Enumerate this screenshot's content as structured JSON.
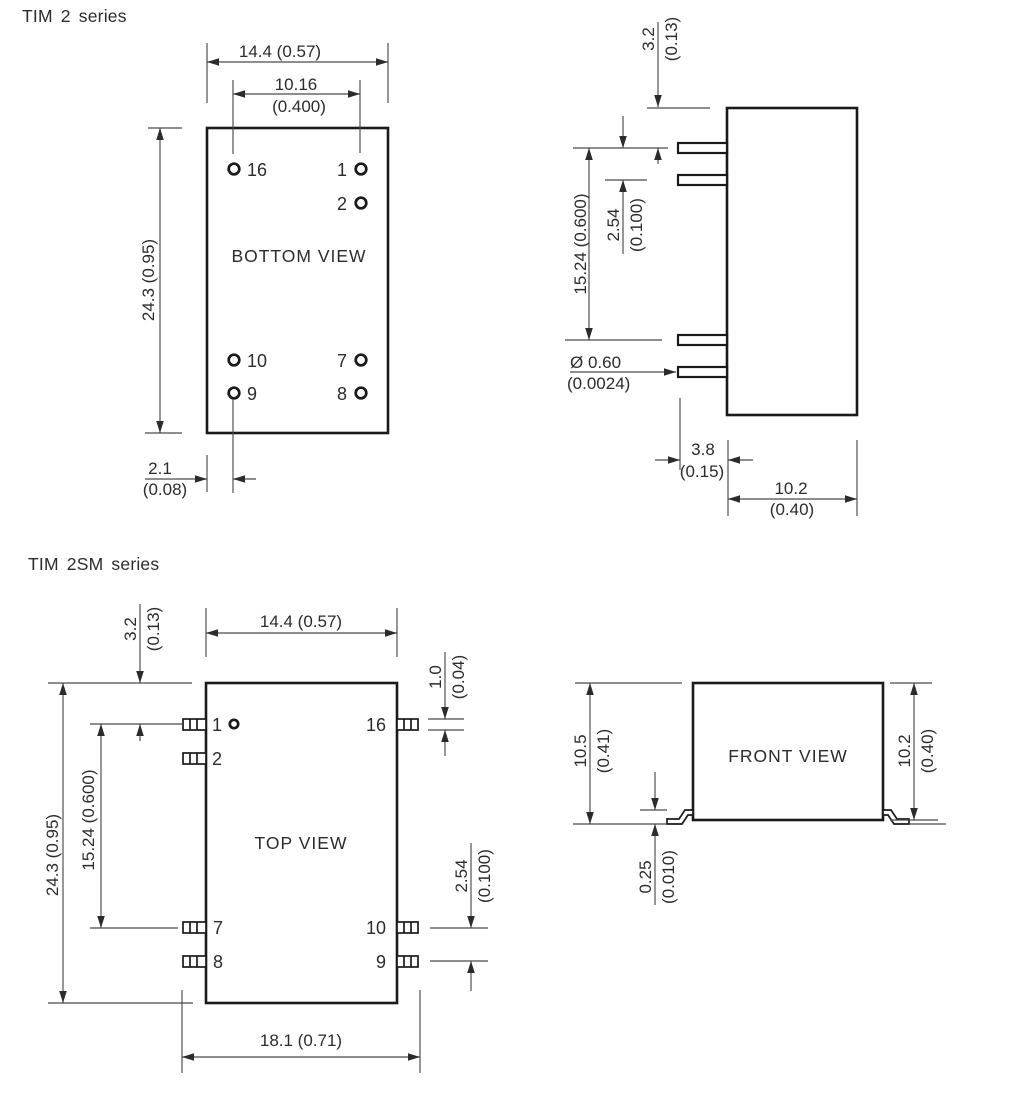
{
  "figures": {
    "tim2": {
      "title": "TIM 2 series",
      "bottom_view": {
        "view_label": "BOTTOM VIEW",
        "pins": {
          "p16": "16",
          "p1": "1",
          "p2": "2",
          "p10": "10",
          "p9": "9",
          "p7": "7",
          "p8": "8"
        },
        "dims": {
          "width": "14.4 (0.57)",
          "pin_span_mm": "10.16",
          "pin_span_in": "(0.400)",
          "height": "24.3 (0.95)",
          "offset_mm": "2.1",
          "offset_in": "(0.08)"
        }
      },
      "side_view": {
        "dims": {
          "standoff_mm": "3.2",
          "standoff_in": "(0.13)",
          "pitch_mm": "2.54",
          "pitch_in": "(0.100)",
          "row_span": "15.24 (0.600)",
          "pin_dia_mm": "Ø 0.60",
          "pin_dia_in": "(0.0024)",
          "pin_len_mm": "3.8",
          "pin_len_in": "(0.15)",
          "depth_mm": "10.2",
          "depth_in": "(0.40)"
        }
      }
    },
    "tim2sm": {
      "title": "TIM 2SM series",
      "top_view": {
        "view_label": "TOP VIEW",
        "pins": {
          "p1": "1",
          "p2": "2",
          "p16": "16",
          "p7": "7",
          "p8": "8",
          "p10": "10",
          "p9": "9"
        },
        "dims": {
          "width": "14.4 (0.57)",
          "standoff_mm": "3.2",
          "standoff_in": "(0.13)",
          "height": "24.3 (0.95)",
          "row_span": "15.24 (0.600)",
          "lead_w_mm": "1.0",
          "lead_w_in": "(0.04)",
          "pitch_mm": "2.54",
          "pitch_in": "(0.100)",
          "overall_width": "18.1 (0.71)"
        }
      },
      "front_view": {
        "view_label": "FRONT VIEW",
        "dims": {
          "height_left_mm": "10.5",
          "height_left_in": "(0.41)",
          "height_right_mm": "10.2",
          "height_right_in": "(0.40)",
          "standoff_mm": "0.25",
          "standoff_in": "(0.010)"
        }
      }
    }
  }
}
